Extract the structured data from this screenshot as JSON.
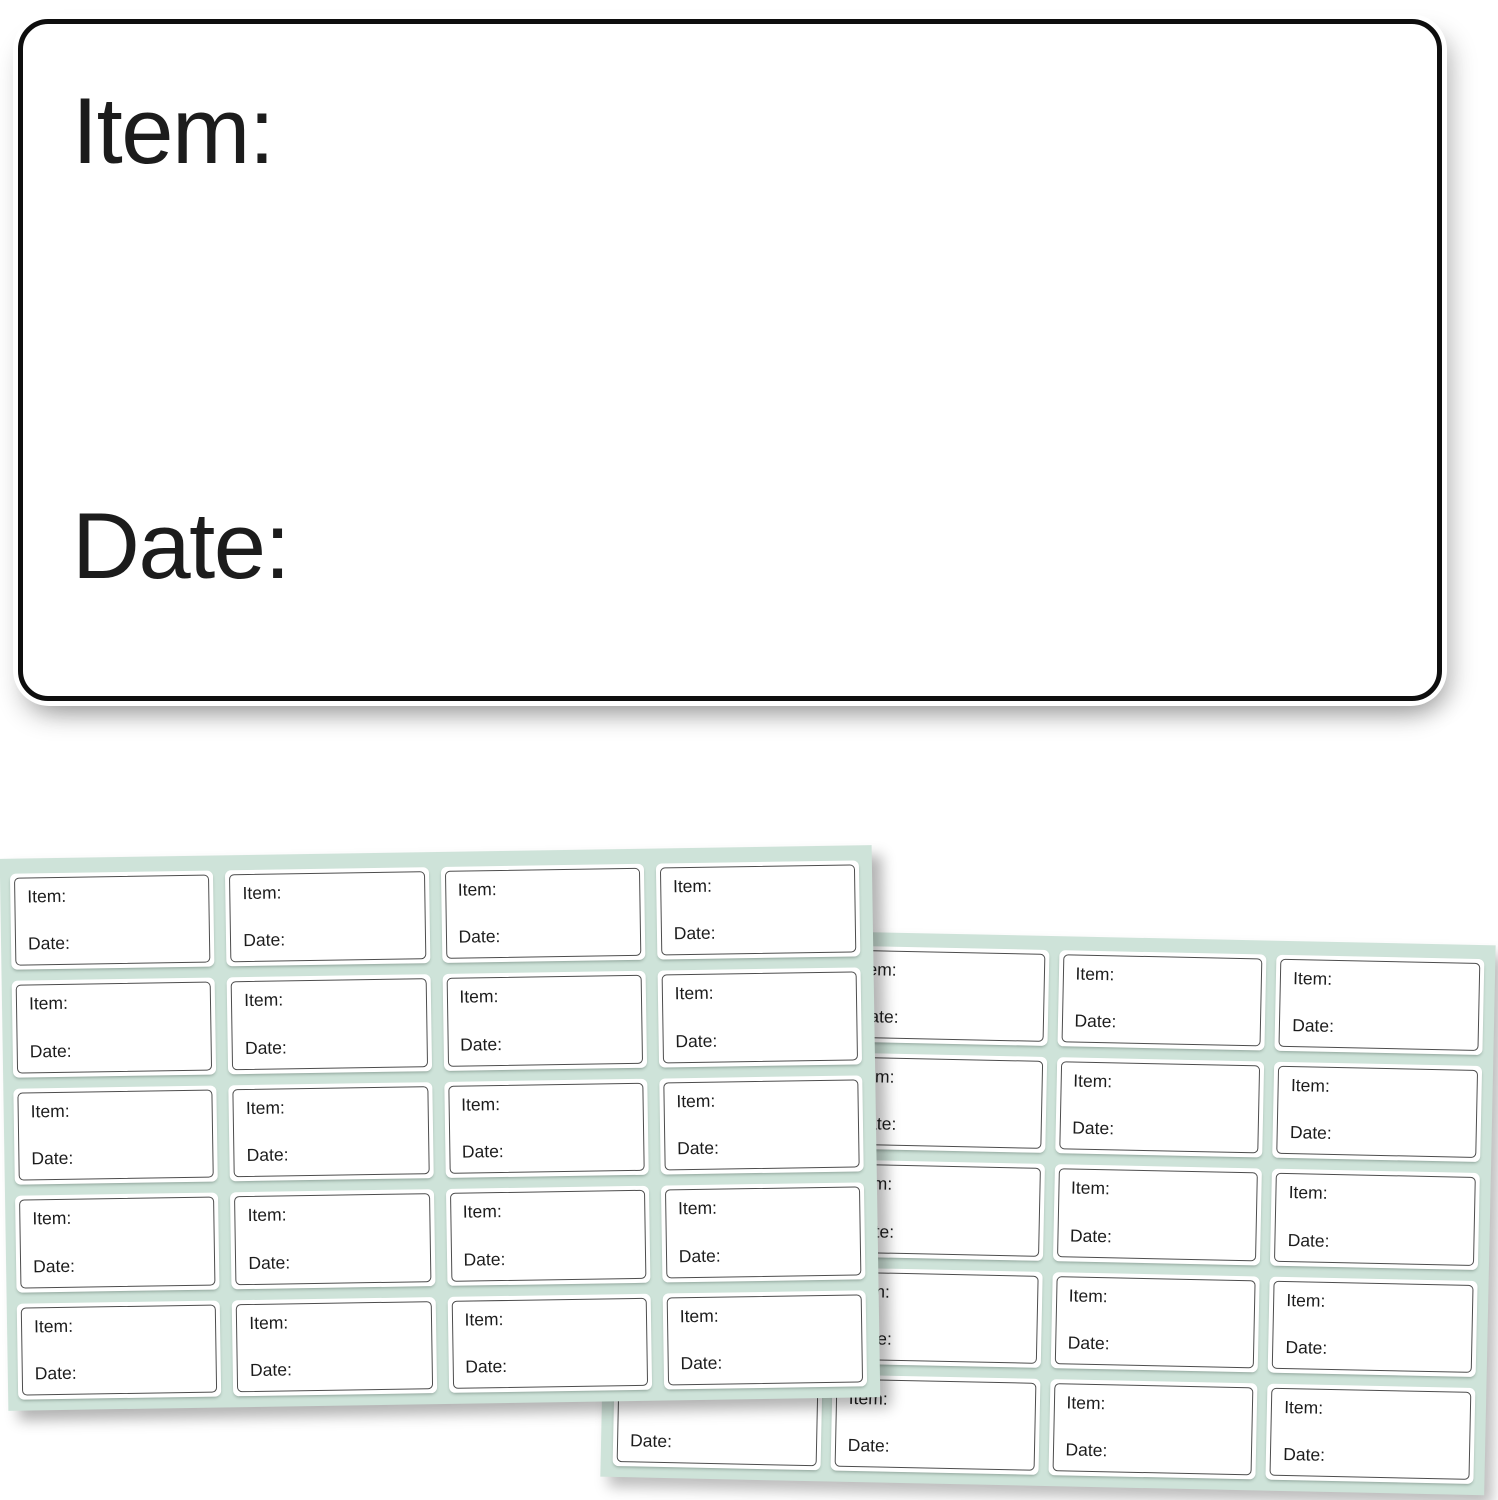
{
  "big_label": {
    "item": "Item:",
    "date": "Date:"
  },
  "label_text": {
    "item": "Item:",
    "date": "Date:"
  },
  "sheets": [
    {
      "id": "left",
      "rows": 5,
      "cols": 4
    },
    {
      "id": "right",
      "rows": 5,
      "cols": 4
    }
  ],
  "colors": {
    "background": "#ffffff",
    "sheet_mint": "#cee3d9",
    "label_border": "#4d4d4d",
    "big_label_border": "#0e0e0e",
    "text": "#1c1c1c"
  }
}
